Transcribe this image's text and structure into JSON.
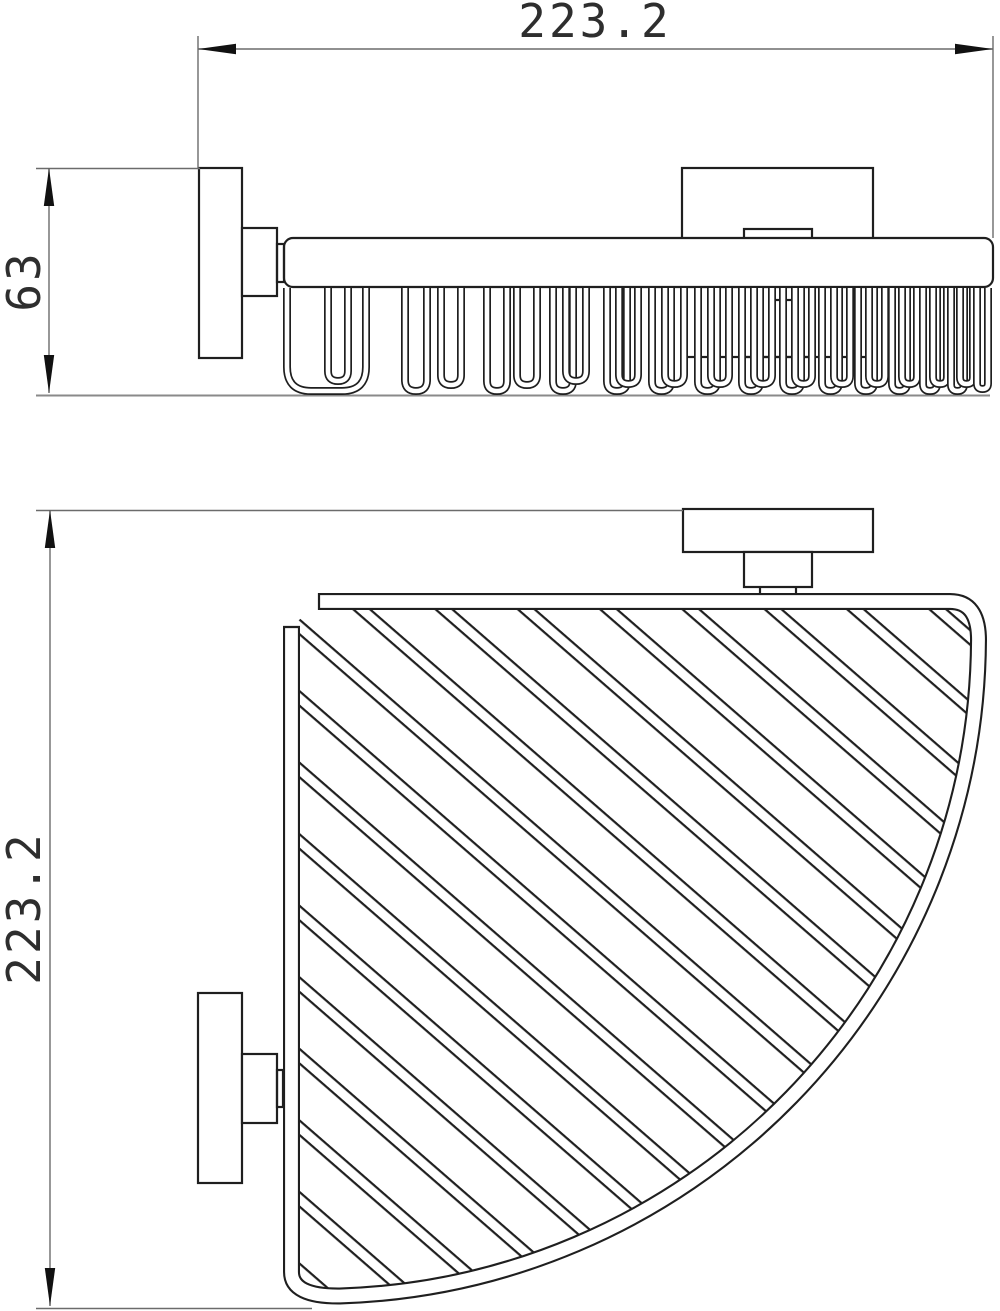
{
  "title": "Corner wire basket technical drawing, two views",
  "dimensions": {
    "width": {
      "label": "223.2",
      "orientation": "horizontal",
      "view": "front"
    },
    "height": {
      "label": "63",
      "orientation": "vertical",
      "view": "front"
    },
    "depth": {
      "label": "223.2",
      "orientation": "vertical",
      "view": "plan"
    }
  },
  "colors": {
    "line": "#1f1f1f",
    "dim_line": "#6b6b6b",
    "arrow": "#111111",
    "text": "#2e2e2e",
    "background": "#ffffff"
  },
  "front_view": {
    "wire_top_y": 288,
    "wire_loops": [
      [
        287,
        366,
        391
      ],
      [
        328,
        348,
        381
      ],
      [
        405,
        427,
        391
      ],
      [
        441,
        461,
        385
      ],
      [
        487,
        507,
        391
      ],
      [
        517,
        537,
        385
      ],
      [
        553,
        573,
        391
      ],
      [
        566,
        586,
        381
      ],
      [
        607,
        627,
        391
      ],
      [
        619,
        638,
        384
      ],
      [
        652,
        671,
        391
      ],
      [
        665,
        684,
        384
      ],
      [
        698,
        717,
        391
      ],
      [
        711,
        729,
        384
      ],
      [
        742,
        760,
        391
      ],
      [
        754,
        772,
        384
      ],
      [
        783,
        801,
        391
      ],
      [
        795,
        812,
        384
      ],
      [
        822,
        839,
        391
      ],
      [
        834,
        850,
        384
      ],
      [
        858,
        874,
        391
      ],
      [
        869,
        885,
        384
      ],
      [
        892,
        907,
        391
      ],
      [
        902,
        917,
        384
      ],
      [
        923,
        937,
        391
      ],
      [
        933,
        947,
        384
      ],
      [
        951,
        964,
        391
      ],
      [
        960,
        973,
        384
      ],
      [
        977,
        988,
        389
      ]
    ]
  },
  "plan_view": {
    "hatch": {
      "angle_deg": 41,
      "pitch": 54,
      "pair_offset": 11,
      "line_width": 2.2,
      "color": "#1f1f1f"
    }
  }
}
